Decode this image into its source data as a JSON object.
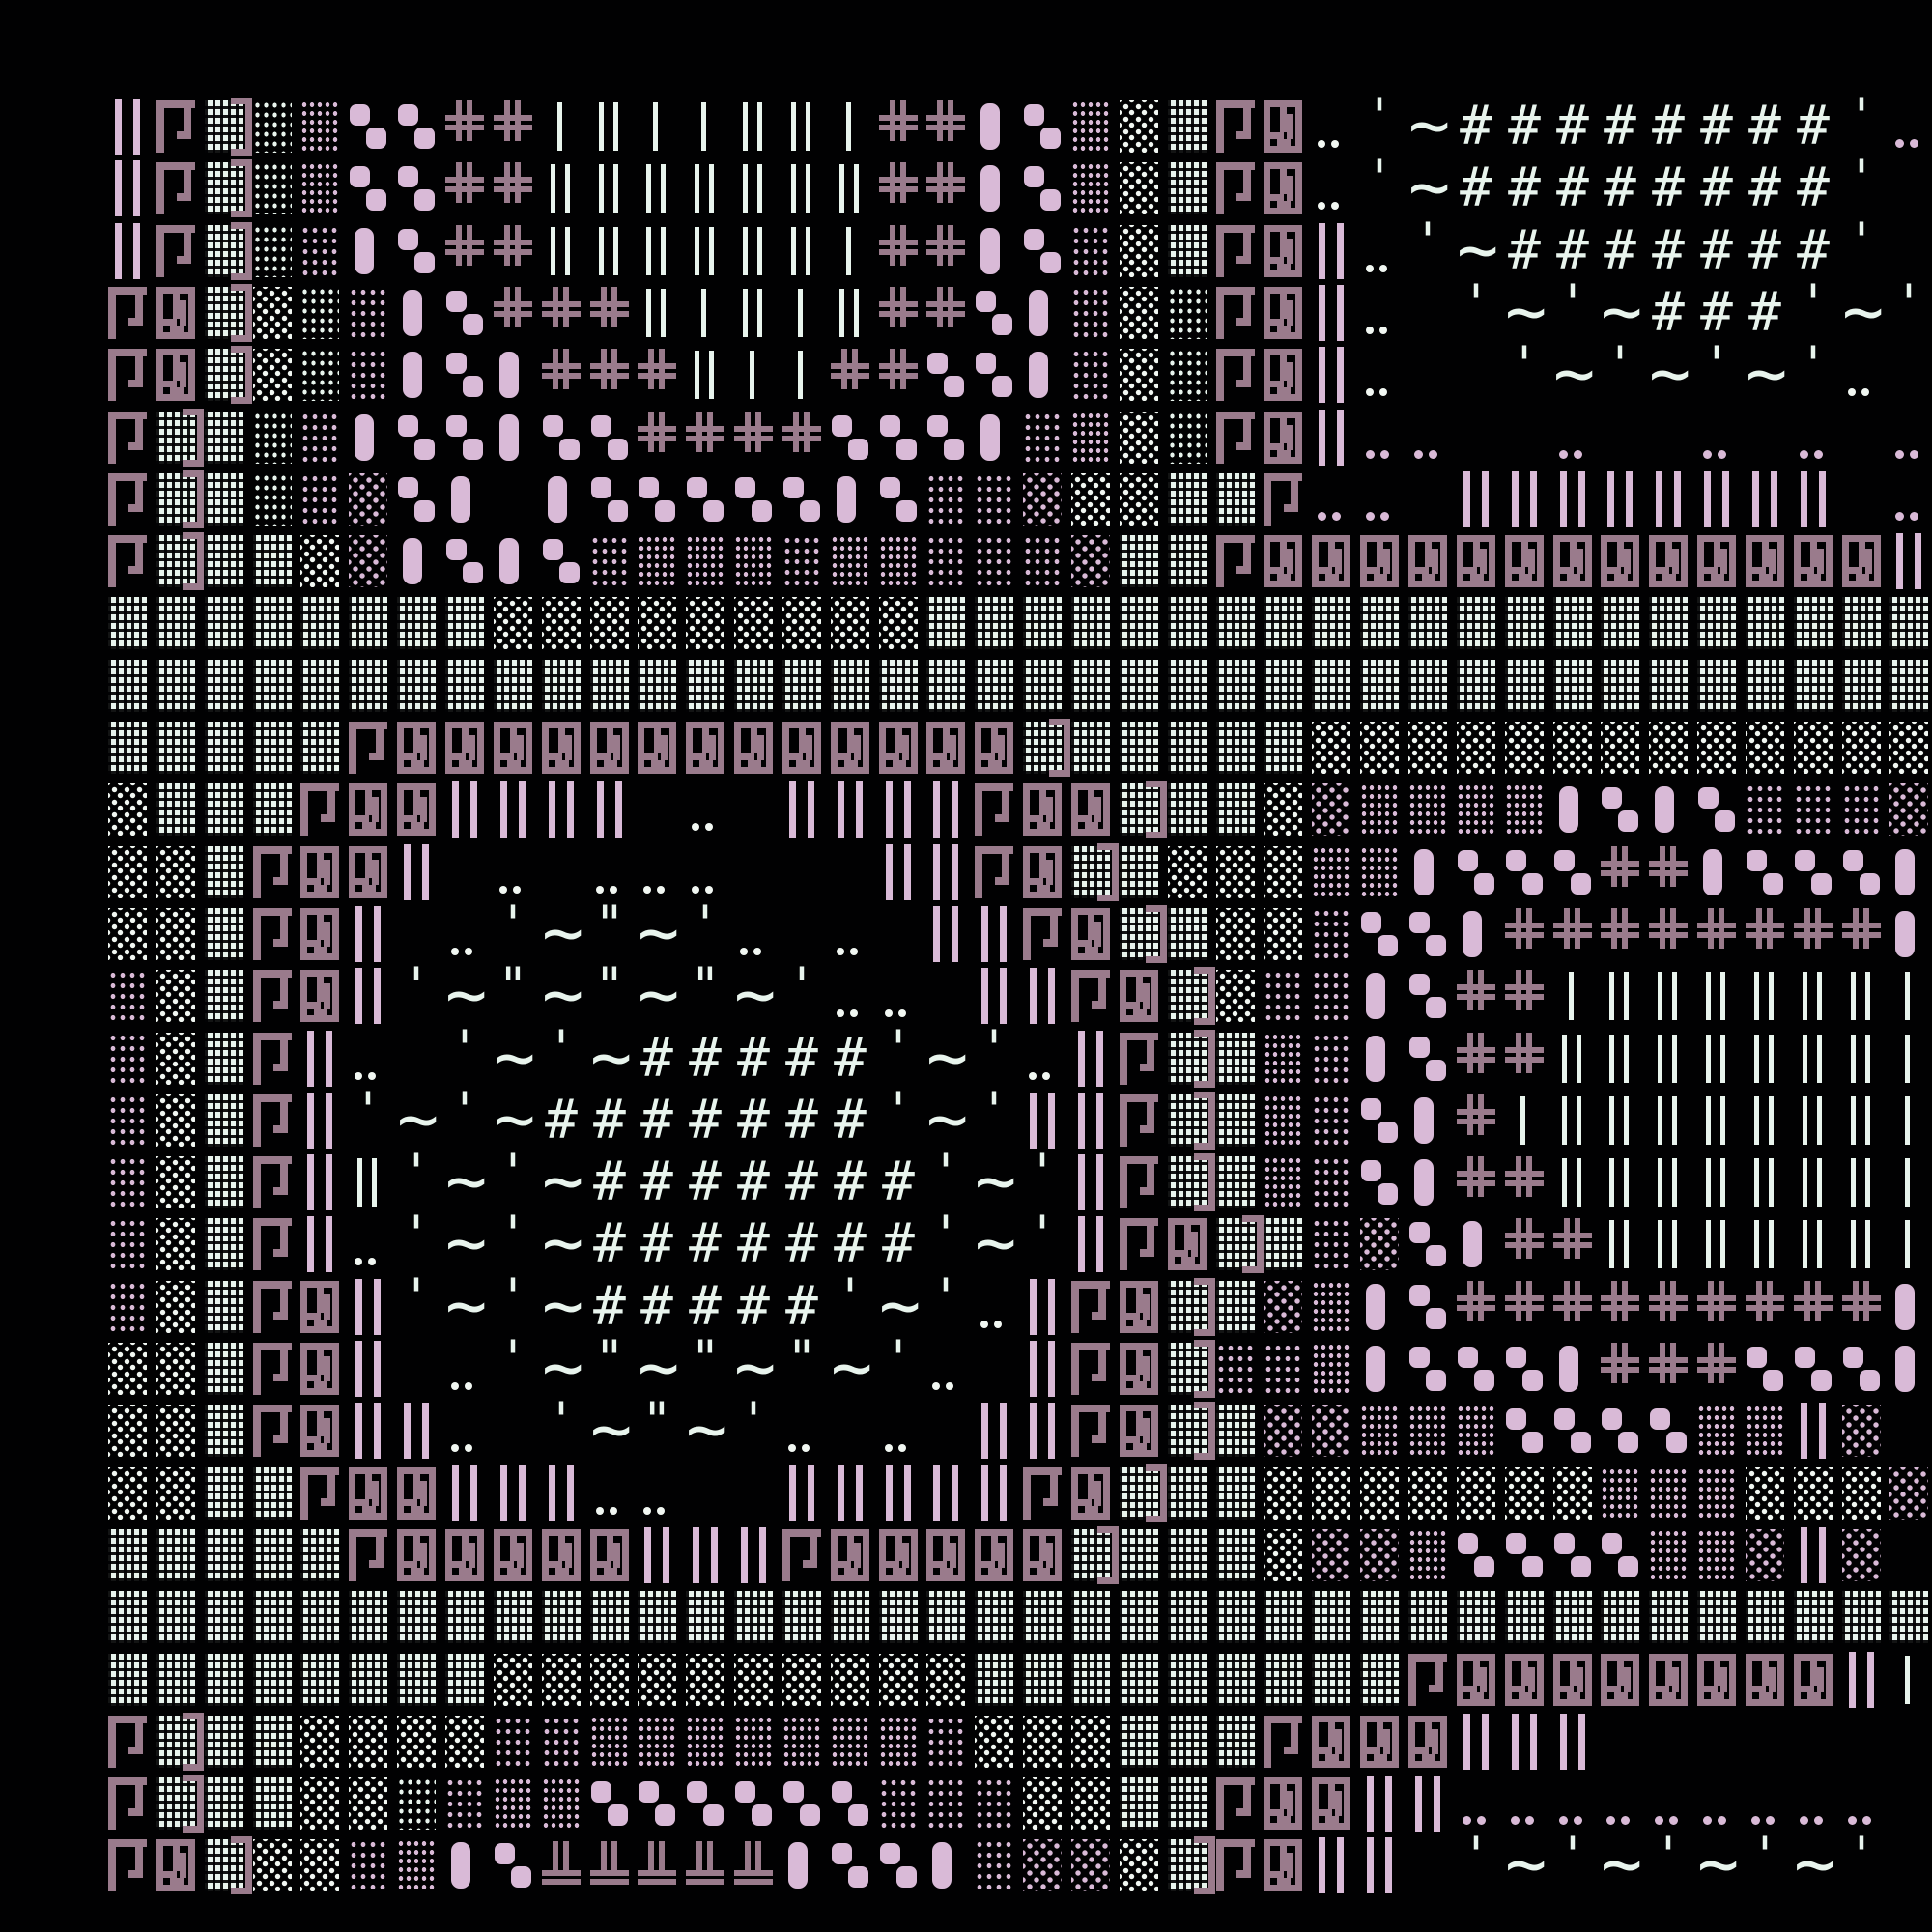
{
  "title": "textmode-art",
  "palette": {
    "background": "#010102",
    "pink": "#d9bad7",
    "mauve": "#9a7b8c",
    "mint": "#e8f4ed",
    "white_dots": "#f1f7f2"
  },
  "art": {
    "columns": 38,
    "rows_count": 29,
    "legend": {
      "I": {
        "name": "double-bar-pink",
        "css": "barI"
      },
      "i": {
        "name": "double-bar-white",
        "css": "bari"
      },
      "l": {
        "name": "single-bar-white",
        "css": "barl"
      },
      "G": {
        "name": "gamma-hook",
        "css": "gamma"
      },
      "g": {
        "name": "gamma-maze-box",
        "css": "gbox"
      },
      "W": {
        "name": "block-dense-white",
        "css": "bW"
      },
      "E": {
        "name": "block-dense-white-bracket",
        "css": "bW bE"
      },
      "w": {
        "name": "block-medium-white",
        "css": "bw"
      },
      "s": {
        "name": "block-sparse-white",
        "css": "bs"
      },
      "P": {
        "name": "block-dense-pink",
        "css": "bP"
      },
      "p": {
        "name": "block-medium-pink",
        "css": "bp"
      },
      "q": {
        "name": "block-sparse-pink",
        "css": "bq"
      },
      "b": {
        "name": "pill-tall-pink",
        "css": "pillb"
      },
      "8": {
        "name": "pill-pair-pink",
        "css": "pill8"
      },
      "+": {
        "name": "cross-double-mauve",
        "css": "plus"
      },
      "T": {
        "name": "cross-bottom-mauve",
        "css": "plusT"
      },
      "#": {
        "name": "hash",
        "css": "ch",
        "char": "#"
      },
      "~": {
        "name": "tilde",
        "css": "ch tld",
        "char": "~"
      },
      "'": {
        "name": "apostrophe",
        "css": "ch apo",
        "char": "'"
      },
      "\"": {
        "name": "double-quote",
        "css": "ch apo",
        "char": "\""
      },
      ":": {
        "name": "dot-pair-white",
        "css": "dotw"
      },
      ",": {
        "name": "dot-pair-pink",
        "css": "dotp"
      }
    },
    "rows": [
      "IGEwP88++lilliil++b8PsWGg:'~########',",
      "IGEwP88++iiiiiii++b8PsWGg:'~########'.",
      "IGEwpb8++iiiiiil++b8psWGgI:'~#######'.",
      "GgEswpb8+++ilili++8bpswGgI:.'~'~###'~'",
      "GgEswpb8b+++ill++88bpswGgI:..'~'~'~':.",
      "GEWwpb88b88++++888bpPswGgI,,..,..,.,.,",
      "GEWwpq8b.b88888b8ppqssWWG,,.IIIIIIII.,",
      "GEWWsqb8b8pPPPpPPpppqWWGgggggggggggggI",
      "WWWWWWWWsssssssssWWWWWWWWWWWWWWWWWWWWW",
      "WWWWWWWWWWWWWWWWWWWWWWWWWWWWWWWWWWWWWW",
      "WWWWWGgggggggggggggEWWWWWsssssssssssss",
      "sWWWGggIIII.:.IIIIGggEWWsqPPPPb8b8pppq",
      "ssWGggI.:.:::...IIGgEWsssPPb888++b888b",
      "ssWGgI.:'~\"~':.:.IIGgEWssp88b++++++++b",
      "psWGgI'~\"~\"~\"~'::.IIGgEsppb8++liiiiiil",
      "psWGI:.'~'~#####'~':IGEWPpb8++iiiiiiil",
      "psWGI'~'~#######'~'IIGEWPp8b+liiiiiiil",
      "psWGIi'~'~#######'~'IGEWPp8b++iiiiiiil",
      "psWGI:'~'~#######'~'IGgEWpq8b++iiiiiil",
      "psWGgI'~'~#####'~':IGgEWqPb8+++++++++b",
      "ssWGgI.:'~\"~\"~\"~':.IGgEppPb888b+++888b",
      "ssWGgII:.'~\"~':.:.IIGgEWqqPPP8888PPIq.",
      "ssWWGggIII::..IIIIIGgEWWsssssssPPPsssq",
      "WWWWWGgggggIIIGgggggEWWWsqqP8888PPqIq.",
      "WWWWWWWWWWWWWWWWWWWWWWWWWWWWWWWWWWWWWW",
      "WWWWWWWWssssssssssWWWWWWWWWGggggggggIl",
      "GEWWssssppPPPPPPPpsssWWWGgggIII.......",
      "GEWWsswpPP888888pppssWWGggII,,,,,,,,,.",
      "GgEsspPb8TTTTTb88bpqqsEGgII.'~'~'~'~'."
    ]
  }
}
